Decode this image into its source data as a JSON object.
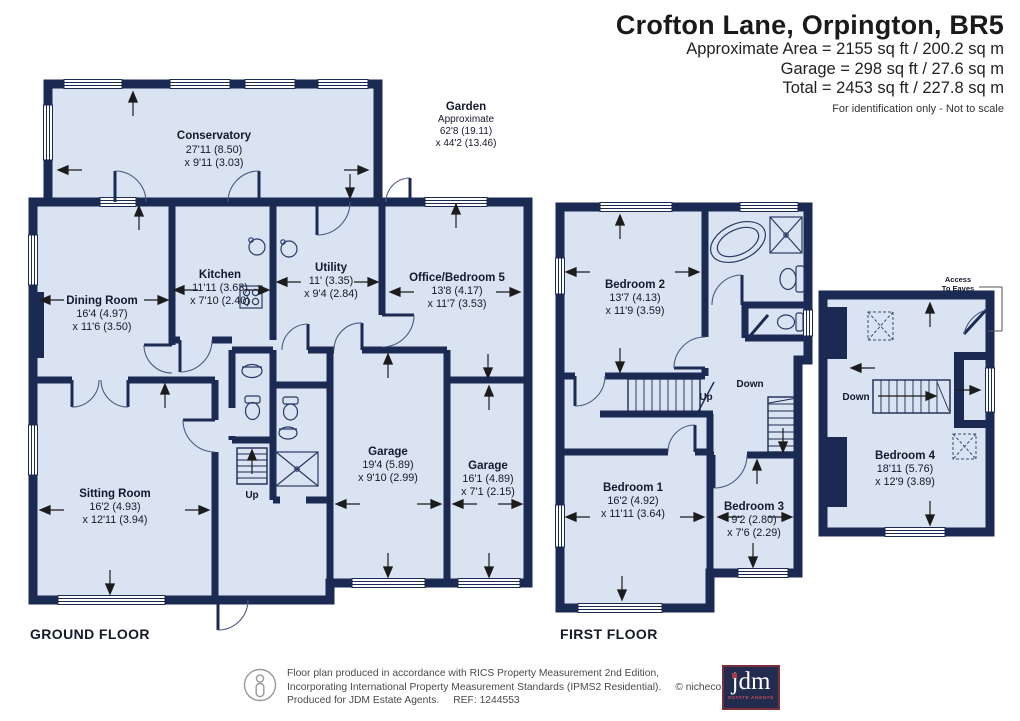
{
  "header": {
    "title": "Crofton Lane, Orpington, BR5",
    "area_line": "Approximate Area = 2155 sq ft / 200.2 sq m",
    "garage_line": "Garage = 298 sq ft / 27.6 sq m",
    "total_line": "Total = 2453 sq ft / 227.8 sq m",
    "disclaimer": "For identification only - Not to scale"
  },
  "floors": {
    "ground": {
      "label": "GROUND FLOOR"
    },
    "first": {
      "label": "FIRST FLOOR"
    }
  },
  "rooms": {
    "conservatory": {
      "name": "Conservatory",
      "dim1": "27'11 (8.50)",
      "dim2": "x 9'11 (3.03)"
    },
    "garden": {
      "name": "Garden",
      "note": "Approximate",
      "dim1": "62'8 (19.11)",
      "dim2": "x 44'2 (13.46)"
    },
    "dining_room": {
      "name": "Dining Room",
      "dim1": "16'4 (4.97)",
      "dim2": "x 11'6 (3.50)"
    },
    "kitchen": {
      "name": "Kitchen",
      "dim1": "11'11 (3.63)",
      "dim2": "x 7'10 (2.40)"
    },
    "utility": {
      "name": "Utility",
      "dim1": "11' (3.35)",
      "dim2": "x 9'4 (2.84)"
    },
    "office_bedroom_5": {
      "name": "Office/Bedroom 5",
      "dim1": "13'8 (4.17)",
      "dim2": "x 11'7 (3.53)"
    },
    "sitting_room": {
      "name": "Sitting Room",
      "dim1": "16'2 (4.93)",
      "dim2": "x 12'11 (3.94)"
    },
    "garage_1": {
      "name": "Garage",
      "dim1": "19'4 (5.89)",
      "dim2": "x 9'10 (2.99)"
    },
    "garage_2": {
      "name": "Garage",
      "dim1": "16'1 (4.89)",
      "dim2": "x 7'1 (2.15)"
    },
    "bedroom_1": {
      "name": "Bedroom 1",
      "dim1": "16'2 (4.92)",
      "dim2": "x 11'11 (3.64)"
    },
    "bedroom_2": {
      "name": "Bedroom 2",
      "dim1": "13'7 (4.13)",
      "dim2": "x 11'9 (3.59)"
    },
    "bedroom_3": {
      "name": "Bedroom 3",
      "dim1": "9'2 (2.80)",
      "dim2": "x 7'6 (2.29)"
    },
    "bedroom_4": {
      "name": "Bedroom 4",
      "dim1": "18'11 (5.76)",
      "dim2": "x 12'9 (3.89)"
    }
  },
  "stairs": {
    "ground_up": "Up",
    "first_up": "Up",
    "first_down": "Down",
    "second_down": "Down"
  },
  "annotations": {
    "access_line1": "Access",
    "access_line2": "To Eaves"
  },
  "footer": {
    "line1": "Floor plan produced in accordance with RICS Property Measurement 2nd Edition,",
    "line2": "Incorporating International Property Measurement Standards (IPMS2 Residential).",
    "copyright": "© nichecom 2025.",
    "line3": "Produced for JDM Estate Agents.",
    "ref": "REF: 1244553"
  },
  "logo": {
    "name": "jdm",
    "subtitle": "ESTATE AGENTS"
  },
  "colors": {
    "wall": "#1b2a52",
    "room_fill": "#d9e3f1",
    "logo_bg": "#232b4e",
    "logo_border": "#7c2f3a"
  }
}
